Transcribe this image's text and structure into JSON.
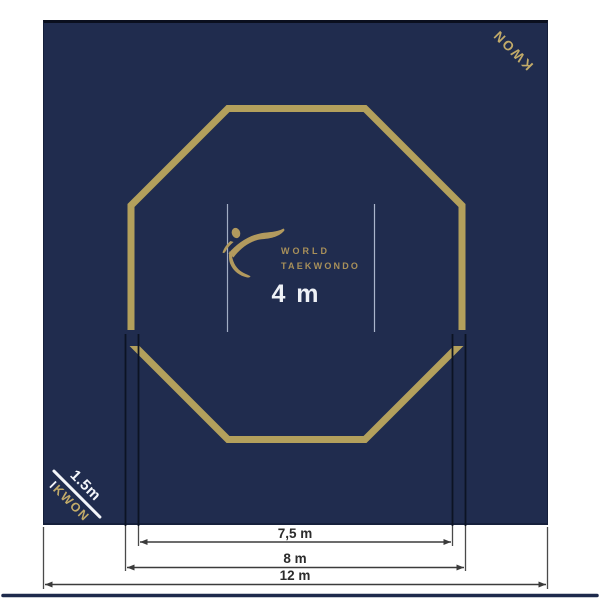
{
  "page": {
    "background": "#ffffff"
  },
  "mat": {
    "brand_top_right": "KWON",
    "wordmark": {
      "line1": "WORLD",
      "line2": "TAEKWONDO"
    },
    "center_dimension_label": "4 m",
    "corner_annotation": {
      "dimension_label": "1.5m",
      "tick": "I",
      "brand": "KWON"
    }
  },
  "dimension_labels": {
    "inner_area": "7,5 m",
    "octagon": "8 m",
    "mat_total": "12 m"
  },
  "icons": {
    "logo": "taekwondo-kick-figure"
  },
  "colors": {
    "mat_navy": "#202c4e",
    "mat_edge_black": "#0a0f1e",
    "ring_gold": "#b3a05c",
    "logo_gold": "#b29a5e",
    "wordmark_gold": "#a8905a",
    "brand_gold": "#c2ab69",
    "dimension_ink": "#3b3b3b",
    "center_line_light": "#cdd8ec",
    "label_white": "#f4f6fa"
  }
}
